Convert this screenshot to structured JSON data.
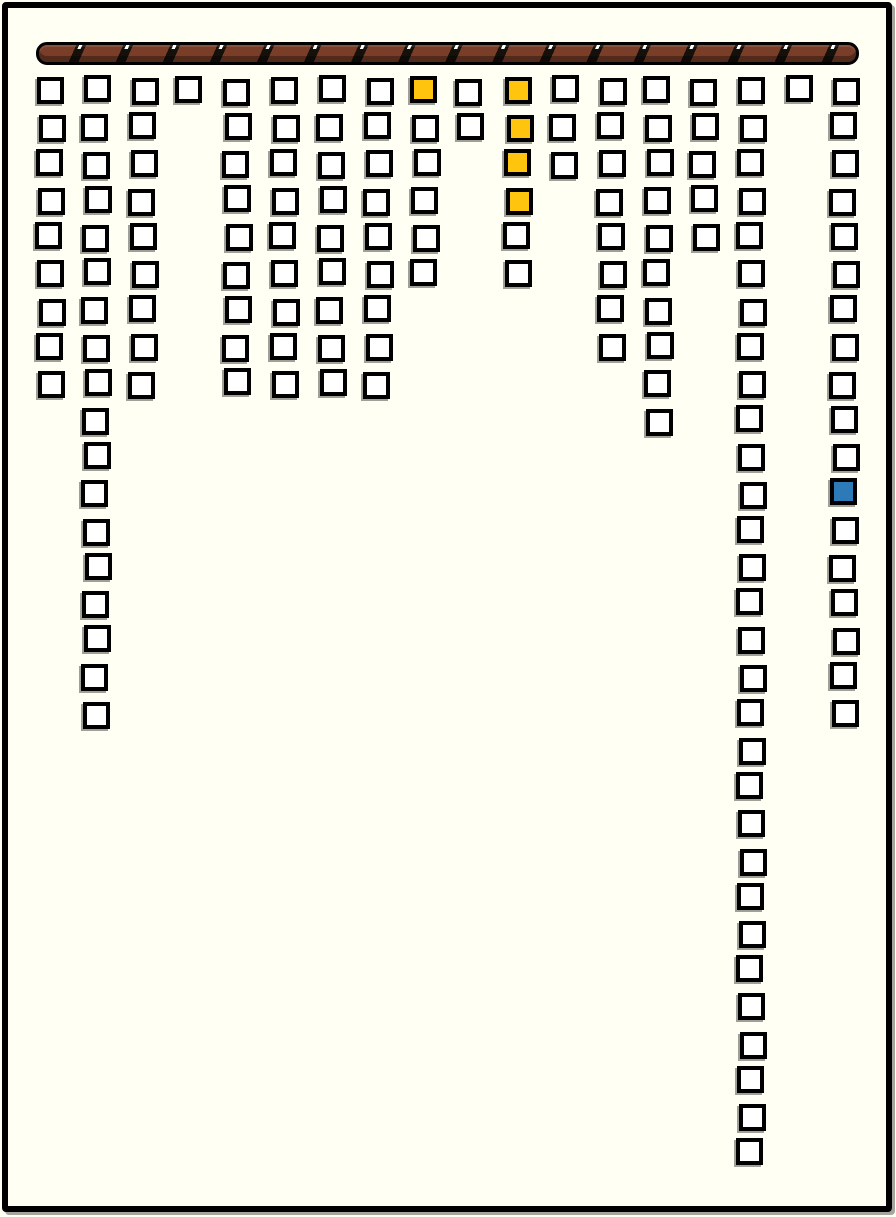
{
  "page": {
    "background_color": "#FFFFF3",
    "frame_color": "#000000"
  },
  "rod": {
    "fill_color": "#7A3E28",
    "stripe_color": "#16100B",
    "tick_color": "#FFFFFF"
  },
  "grid": {
    "cell_size": 27,
    "row_start_y": 77,
    "row_pitch": 36.66,
    "colors": {
      "white": "#FFFFFF",
      "yellow": "#FFC40D",
      "blue": "#2C7BB8",
      "border": "#000000",
      "shadow": "#A0A098"
    },
    "columns": [
      {
        "x": 37,
        "count": 9,
        "highlights": {}
      },
      {
        "x": 83,
        "count": 18,
        "highlights": {}
      },
      {
        "x": 130,
        "count": 9,
        "highlights": {}
      },
      {
        "x": 177,
        "count": 1,
        "highlights": {}
      },
      {
        "x": 224,
        "count": 9,
        "highlights": {}
      },
      {
        "x": 271,
        "count": 9,
        "highlights": {}
      },
      {
        "x": 318,
        "count": 9,
        "highlights": {}
      },
      {
        "x": 365,
        "count": 9,
        "highlights": {}
      },
      {
        "x": 412,
        "count": 6,
        "highlights": {
          "1": "yellow"
        }
      },
      {
        "x": 456,
        "count": 2,
        "highlights": {}
      },
      {
        "x": 505,
        "count": 6,
        "highlights": {
          "1": "yellow",
          "2": "yellow",
          "3": "yellow",
          "4": "yellow"
        }
      },
      {
        "x": 551,
        "count": 3,
        "highlights": {}
      },
      {
        "x": 598,
        "count": 8,
        "highlights": {}
      },
      {
        "x": 645,
        "count": 10,
        "highlights": {}
      },
      {
        "x": 691,
        "count": 5,
        "highlights": {}
      },
      {
        "x": 738,
        "count": 30,
        "highlights": {}
      },
      {
        "x": 785,
        "count": 1,
        "highlights": {}
      },
      {
        "x": 831,
        "count": 18,
        "highlights": {
          "12": "blue"
        }
      }
    ]
  }
}
